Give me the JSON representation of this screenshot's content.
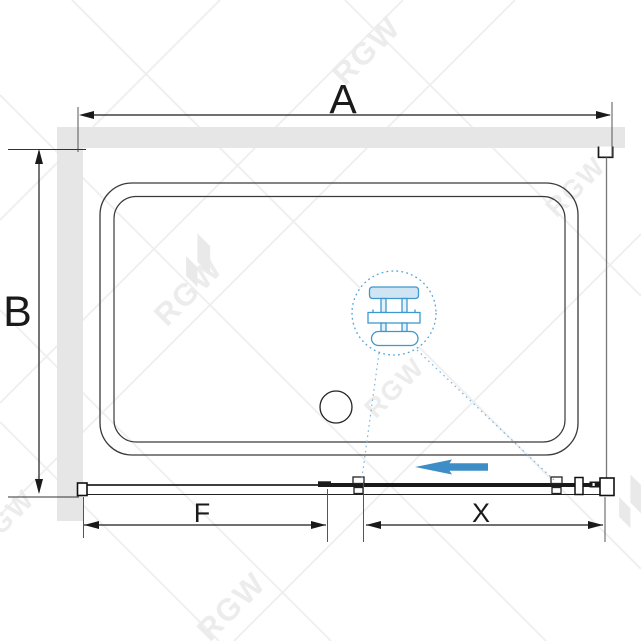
{
  "diagram": {
    "dimension_labels": {
      "a": "A",
      "b": "B",
      "f": "F",
      "x": "X"
    }
  },
  "watermark": {
    "text": "RGW"
  },
  "colors": {
    "wall_fill": "#e6e6e6",
    "line": "#1a1a1a",
    "tray_line": "#3a3a3a",
    "ext_line": "#555555",
    "side_panel_line": "#777777",
    "accent_blue": "#3d8ec6",
    "detail_blue": "#54a3d6",
    "mech_blue": "#3f97ce",
    "mech_fill_light": "#cfe5f4",
    "leader_blue": "#79b5de",
    "watermark_line": "#efefef",
    "watermark_text": "#ececec",
    "watermark_logo": "#e9e9e9"
  }
}
